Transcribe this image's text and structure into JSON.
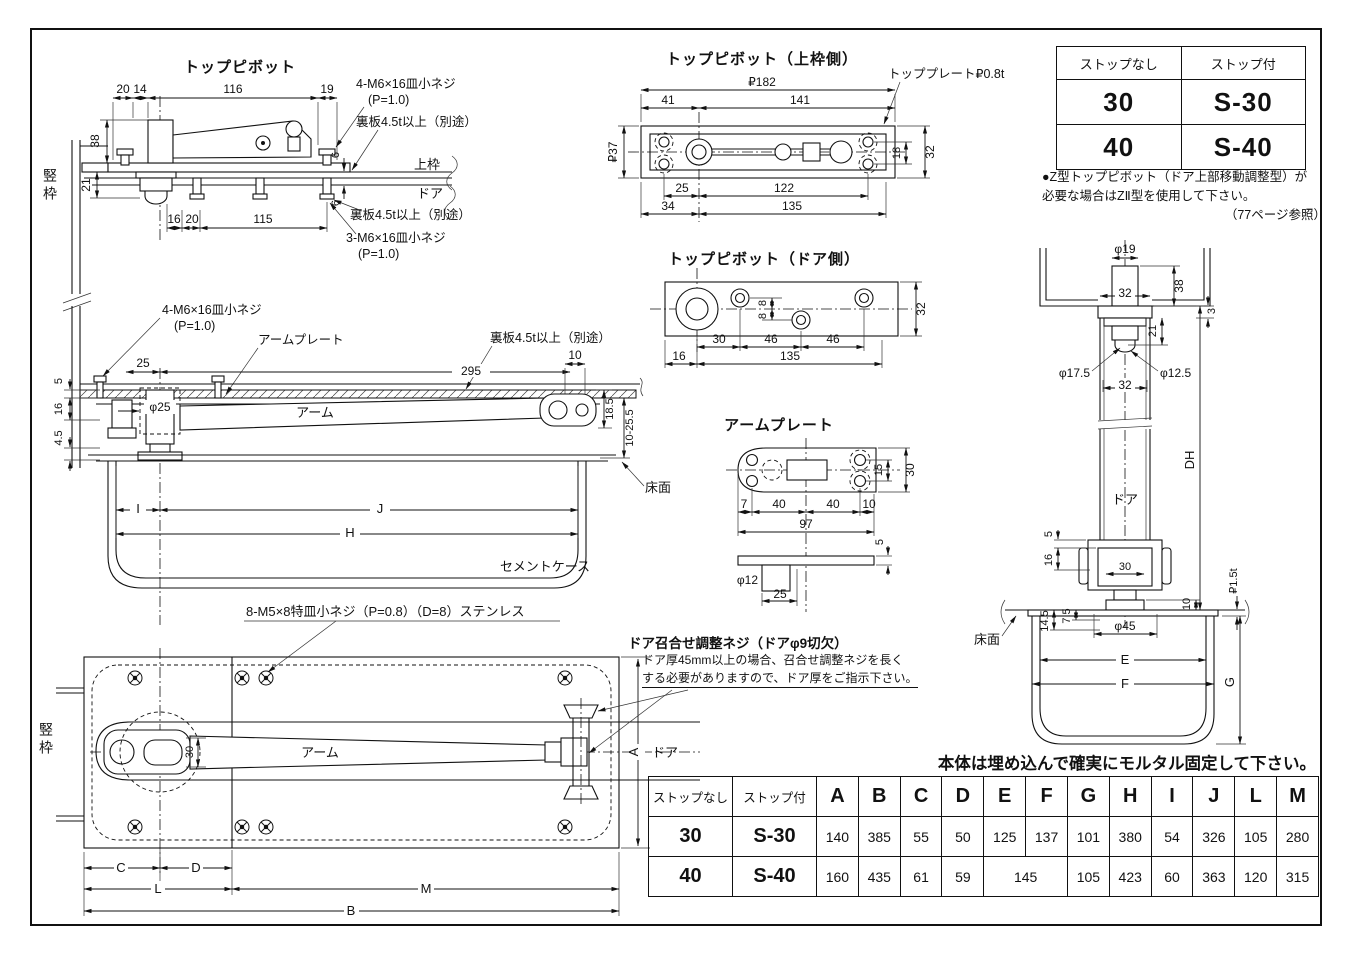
{
  "fig_top_pivot": {
    "title": "トップピボット",
    "screw4": "4-M6×16皿小ネジ",
    "p10a": "(P=1.0)",
    "back_top": "裏板4.5t以上（別途）",
    "kamiwaku": "上枠",
    "door": "ドア",
    "back_bottom": "裏板4.5t以上（別途）",
    "screw3": "3-M6×16皿小ネジ",
    "p10b": "(P=1.0)",
    "jamb": "竪枠",
    "d20": "20",
    "d14": "14",
    "d116": "116",
    "d19": "19",
    "d38": "38",
    "d21": "21",
    "d6a": "6",
    "d6b": "6",
    "d16": "16",
    "d20b": "20",
    "d115": "115"
  },
  "fig_section": {
    "screw4": "4-M6×16皿小ネジ",
    "p10": "(P=1.0)",
    "arm_plate": "アームプレート",
    "back": "裏板4.5t以上（別途）",
    "arm": "アーム",
    "cement_case": "セメントケース",
    "floor": "床面",
    "d25": "25",
    "d295": "295",
    "d10": "10",
    "d5": "5",
    "d16": "16",
    "d45": "4.5",
    "dphi25": "φ25",
    "d185": "18.5",
    "d1025": "10-25.5",
    "dI": "I",
    "dJ": "J",
    "dH": "H"
  },
  "fig_plan": {
    "screw8": "8-M5×8特皿小ネジ（P=0.8）（D=8）ステンレス",
    "arm": "アーム",
    "jamb": "竪枠",
    "door": "ドア",
    "d30": "30",
    "dA": "A",
    "dC": "C",
    "dD": "D",
    "dL": "L",
    "dM": "M",
    "dB": "B"
  },
  "adjust_note": {
    "line1": "ドア召合せ調整ネジ（ドアφ9切欠）",
    "line2": "ドア厚45mm以上の場合、召合せ調整ネジを長く",
    "line3": "する必要がありますので、ドア厚をご指示下さい。"
  },
  "fig_top_plate": {
    "title": "トップピボット（上枠側）",
    "plate_label": "トッププレート₽0.8t",
    "d182": "₽182",
    "d41": "41",
    "d141": "141",
    "d37": "₽37",
    "d18": "18",
    "d32": "32",
    "d25": "25",
    "d122": "122",
    "d34": "34",
    "d135": "135"
  },
  "fig_door_side": {
    "title": "トップピボット（ドア側）",
    "d8a": "8",
    "d8b": "8",
    "d32": "32",
    "d30": "30",
    "d46a": "46",
    "d46b": "46",
    "d16": "16",
    "d135": "135"
  },
  "fig_arm_plate": {
    "title": "アームプレート",
    "d15": "15",
    "d30": "30",
    "d7": "7",
    "d40a": "40",
    "d40b": "40",
    "d10": "10",
    "d97": "97",
    "dphi12": "φ12",
    "d25": "25",
    "d5": "5"
  },
  "fig_elevation": {
    "door": "ドア",
    "floor": "床面",
    "dphi19": "φ19",
    "d32a": "32",
    "d38": "38",
    "d3": "3",
    "d21": "21",
    "dphi175": "φ17.5",
    "dphi125": "φ12.5",
    "d32b": "32",
    "dDH": "DH",
    "d5": "5",
    "d16": "16",
    "d30": "30",
    "d10": "10",
    "d15t": "₽1.5t",
    "d145": "14.5",
    "d75": "7.5",
    "dphi45": "φ45",
    "dE": "E",
    "dF": "F",
    "dG": "G"
  },
  "model_table": {
    "h1": "ストップなし",
    "h2": "ストップ付",
    "r1c1": "30",
    "r1c2": "S-30",
    "r2c1": "40",
    "r2c2": "S-40"
  },
  "z_note": {
    "line1": "●Z型トップピボット（ドア上部移動調整型）が",
    "line2": "必要な場合はZⅡ型を使用して下さい。",
    "line3": "（77ページ参照）"
  },
  "mortar_note": "本体は埋め込んで確実にモルタル固定して下さい。",
  "dim_table": {
    "headers": [
      "ストップなし",
      "ストップ付",
      "A",
      "B",
      "C",
      "D",
      "E",
      "F",
      "G",
      "H",
      "I",
      "J",
      "L",
      "M"
    ],
    "row1": [
      "30",
      "S-30",
      "140",
      "385",
      "55",
      "50",
      "125",
      "137",
      "101",
      "380",
      "54",
      "326",
      "105",
      "280"
    ],
    "row2": [
      "40",
      "S-40",
      "160",
      "435",
      "61",
      "59",
      "145",
      "105",
      "423",
      "60",
      "363",
      "120",
      "315"
    ]
  }
}
